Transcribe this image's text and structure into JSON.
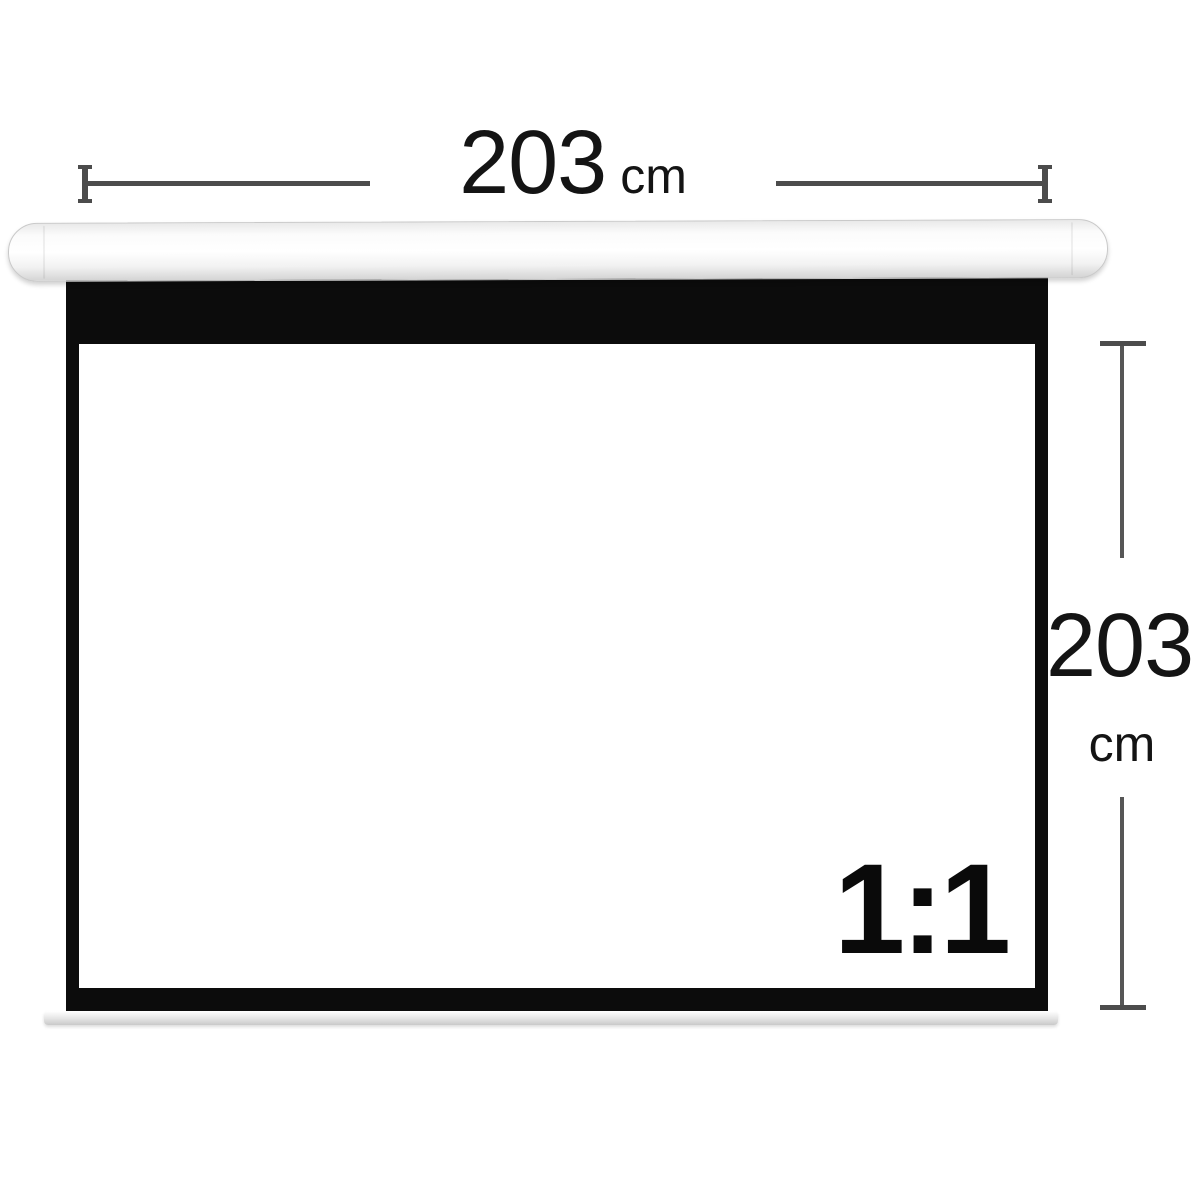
{
  "dimensions": {
    "width": {
      "value": "203",
      "unit": "cm"
    },
    "height": {
      "value": "203",
      "unit": "cm"
    }
  },
  "screen": {
    "aspect_ratio_label": "1:1"
  },
  "colors": {
    "background": "#ffffff",
    "dimension_line": "#4c4c4c",
    "label_text": "#141414",
    "screen_border_black": "#0c0c0c",
    "viewing_area_white": "#ffffff",
    "housing_shade": "#d4d4d4",
    "weight_bar": "#e4e4e4"
  }
}
